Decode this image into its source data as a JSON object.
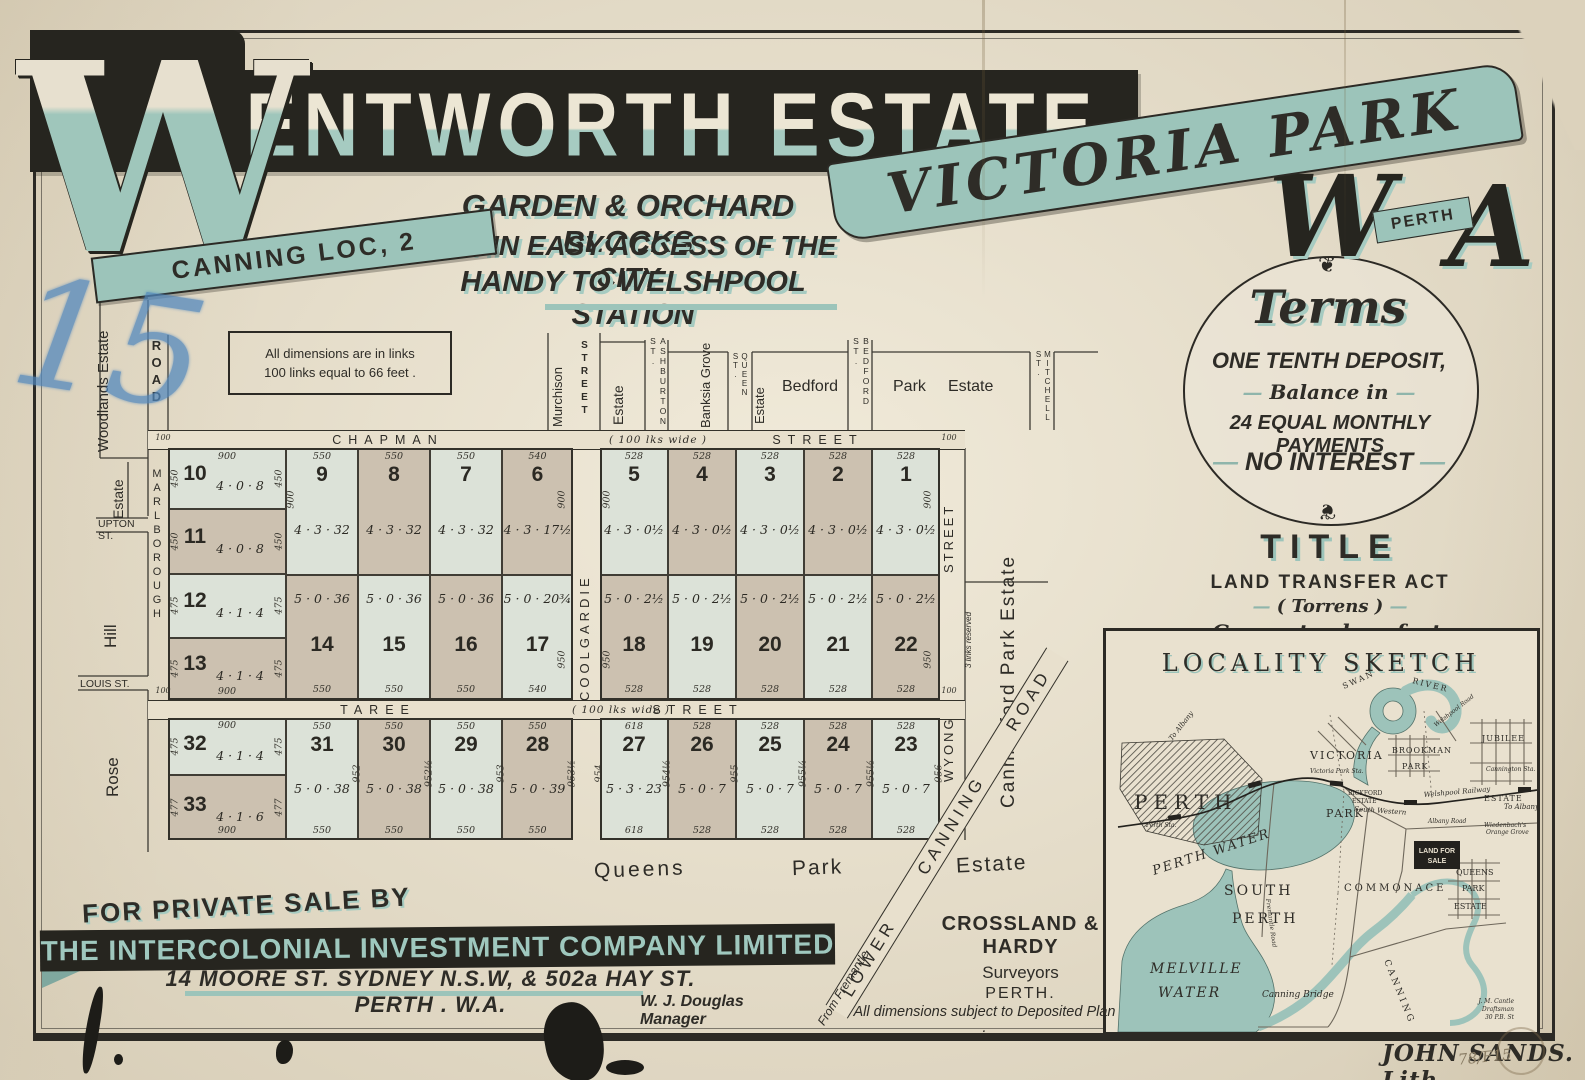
{
  "colors": {
    "paper": "#e9e1ce",
    "ink": "#2e2c27",
    "teal": "#9cc4ba",
    "teal_dark": "#7fa89f",
    "lot_pale": "#dce2d8",
    "lot_tan": "#ccc1b0",
    "water": "#9dc3ba",
    "blue_crayon": "#4f86bd"
  },
  "poster": {
    "big_initial": "W",
    "title_rest": "ENTWORTH ESTATE",
    "canning_ribbon": "CANNING LOC, 2",
    "subtitle1": "GARDEN & ORCHARD BLOCKS",
    "subtitle2": "WITHIN EASY ACCESS OF THE CITY",
    "subtitle3": "HANDY TO WELSHPOOL STATION",
    "victoria_ribbon": "VICTORIA PARK",
    "wa_w": "W",
    "wa_a": "A",
    "perth_ribbon": "PERTH",
    "handwritten_number": "15"
  },
  "terms": {
    "ornament": "❦",
    "heading": "Terms",
    "line1": "ONE TENTH DEPOSIT,",
    "line2": "Balance in",
    "line3": "24 EQUAL MONTHLY PAYMENTS",
    "line4": "NO INTEREST",
    "dash": "—"
  },
  "title_block": {
    "heading": "TITLE",
    "line1": "LAND TRANSFER ACT",
    "line2": "( Torrens )",
    "line3": "Guaranteed perfect."
  },
  "note": {
    "line1": "All dimensions are in links",
    "line2": "100 links equal to 66 feet ."
  },
  "sale": {
    "for_private_sale": "FOR PRIVATE SALE BY",
    "company": "THE INTERCOLONIAL INVESTMENT COMPANY LIMITED",
    "address": "14 MOORE ST. SYDNEY N.S.W, & 502a HAY ST. PERTH . W.A.",
    "manager": "W. J. Douglas  Manager"
  },
  "surveyors": {
    "name": "CROSSLAND & HARDY",
    "role": "Surveyors",
    "city": "PERTH.",
    "disclaimer": "All dimensions subject to Deposited Plan ."
  },
  "imprint": {
    "lith": "JOHN SANDS. Lith.",
    "file_number": "78/F15"
  },
  "plan": {
    "streets": {
      "chapman": "CHAPMAN",
      "taree": "TAREE",
      "street": "STREET",
      "width_note": "( 100 lks wide )",
      "marlborough": "MARLBOROUGH",
      "road": "ROAD",
      "coolgardie": "COOLGARDIE",
      "wyong": "WYONG",
      "wyong_street": "STREET",
      "murchison": "Murchison",
      "murchison_street": "STREET",
      "reserve": "3 links reserved",
      "tick": "100"
    },
    "neighbors": {
      "woodlands": "Woodlands Estate",
      "estate_upton": "Estate",
      "upton": "UPTON ST.",
      "hill": "Hill",
      "louis": "LOUIS ST.",
      "rose": "Rose",
      "estate_murchison": "Estate",
      "ashburton": "ASHBURTON ST.",
      "banksia": "Banksia Grove",
      "queen": "QUEEN ST.",
      "estate_queen": "Estate",
      "bedford": "Bedford",
      "bedford_st": "BEDFORD ST.",
      "park": "Park",
      "estate_bedford": "Estate",
      "mitchell": "MITCHELL ST.",
      "canningford": "Canningford Park Estate",
      "queens": "Queens",
      "queens_park": "Park",
      "queens_estate": "Estate",
      "lower_canning": "LOWER CANNING ROAD",
      "from_fremantle": "From Fremantle"
    },
    "lots": {
      "nw_width": "900",
      "nw": [
        {
          "n": "10",
          "a": "4 · 0 · 8",
          "side": "450"
        },
        {
          "n": "11",
          "a": "4 · 0 · 8",
          "side": "450"
        },
        {
          "n": "12",
          "a": "4 · 1 · 4",
          "side": "475"
        },
        {
          "n": "13",
          "a": "4 · 1 · 4",
          "side": "475"
        }
      ],
      "n_left": [
        {
          "n": "9",
          "a": "4 · 3 · 32",
          "w": "550"
        },
        {
          "n": "8",
          "a": "4 · 3 · 32",
          "w": "550"
        },
        {
          "n": "7",
          "a": "4 · 3 · 32",
          "w": "550"
        },
        {
          "n": "6",
          "a": "4 · 3 · 17½",
          "w": "540"
        }
      ],
      "s_of_n_left": [
        {
          "n": "14",
          "a": "5 · 0 · 36",
          "w": "550"
        },
        {
          "n": "15",
          "a": "5 · 0 · 36",
          "w": "550"
        },
        {
          "n": "16",
          "a": "5 · 0 · 36",
          "w": "550"
        },
        {
          "n": "17",
          "a": "5 · 0 · 20¾",
          "w": "540"
        }
      ],
      "n_right": [
        {
          "n": "5",
          "a": "4 · 3 · 0½",
          "w": "528"
        },
        {
          "n": "4",
          "a": "4 · 3 · 0½",
          "w": "528"
        },
        {
          "n": "3",
          "a": "4 · 3 · 0½",
          "w": "528"
        },
        {
          "n": "2",
          "a": "4 · 3 · 0½",
          "w": "528"
        },
        {
          "n": "1",
          "a": "4 · 3 · 0½",
          "w": "528"
        }
      ],
      "s_of_n_right": [
        {
          "n": "18",
          "a": "5 · 0 · 2½",
          "w": "528"
        },
        {
          "n": "19",
          "a": "5 · 0 · 2½",
          "w": "528"
        },
        {
          "n": "20",
          "a": "5 · 0 · 2½",
          "w": "528"
        },
        {
          "n": "21",
          "a": "5 · 0 · 2½",
          "w": "528"
        },
        {
          "n": "22",
          "a": "5 · 0 · 2½",
          "w": "528"
        }
      ],
      "sw": [
        {
          "n": "32",
          "a": "4 · 1 · 4",
          "side": "475",
          "w": "900"
        },
        {
          "n": "33",
          "a": "4 · 1 · 6",
          "side": "477",
          "w": "900"
        }
      ],
      "s_left": [
        {
          "n": "31",
          "a": "5 · 0 · 38",
          "w": "550"
        },
        {
          "n": "30",
          "a": "5 · 0 · 38",
          "w": "550"
        },
        {
          "n": "29",
          "a": "5 · 0 · 38",
          "w": "550"
        },
        {
          "n": "28",
          "a": "5 · 0 · 39",
          "w": "550"
        }
      ],
      "s_right": [
        {
          "n": "27",
          "a": "5 · 3 · 23",
          "w": "618"
        },
        {
          "n": "26",
          "a": "5 · 0 · 7",
          "w": "528"
        },
        {
          "n": "25",
          "a": "5 · 0 · 7",
          "w": "528"
        },
        {
          "n": "24",
          "a": "5 · 0 · 7",
          "w": "528"
        },
        {
          "n": "23",
          "a": "5 · 0 · 7",
          "w": "528"
        }
      ],
      "edge_dims": {
        "tier1": "900",
        "tier2": "950",
        "bottom_left": [
          "952",
          "952½",
          "953",
          "953½"
        ],
        "bottom_right": [
          "954",
          "954½",
          "955",
          "955¼",
          "955½",
          "956"
        ],
        "street_tick": "100"
      }
    }
  },
  "locality": {
    "title": "LOCALITY SKETCH",
    "perth": "PERTH",
    "perth_sta": "Perth Sta.",
    "perth_water": "PERTH  WATER",
    "south": "SOUTH",
    "perth2": "PERTH",
    "melville": "MELVILLE",
    "water": "WATER",
    "victoria": "VICTORIA",
    "park": "PARK",
    "victoria_sta": "Victoria Park Sta.",
    "brookman": "BROOKMAN",
    "park2": "PARK",
    "jubilee": "JUBILEE",
    "estate": "ESTATE",
    "bickford": "BICKFORD",
    "estate2": "ESTATE",
    "commonage": "COMMONACE",
    "queens": "QUEENS",
    "park3": "PARK",
    "estate3": "ESTATE",
    "land_for": "LAND FOR",
    "sale": "SALE",
    "wiedenbach": "Wiedenbach's",
    "orange_grove": "Orange Grove",
    "canning_bridge": "Canning Bridge",
    "canning": "CANNING",
    "swan": "SWAN",
    "river": "RIVER",
    "to_albany": "To Albany",
    "to_albany2": "To Albany",
    "cannington": "Cannington Sta.",
    "welshpool_rail": "Welshpool Railway",
    "south_western": "South Western",
    "welshpool_rd": "Welshpool Road",
    "albany_rd": "Albany Road",
    "fremantle_rd": "Fremantle Road",
    "draftsman1": "J. M. Cantle",
    "draftsman2": "Draftsman",
    "draftsman3": "30 P.B. St"
  }
}
